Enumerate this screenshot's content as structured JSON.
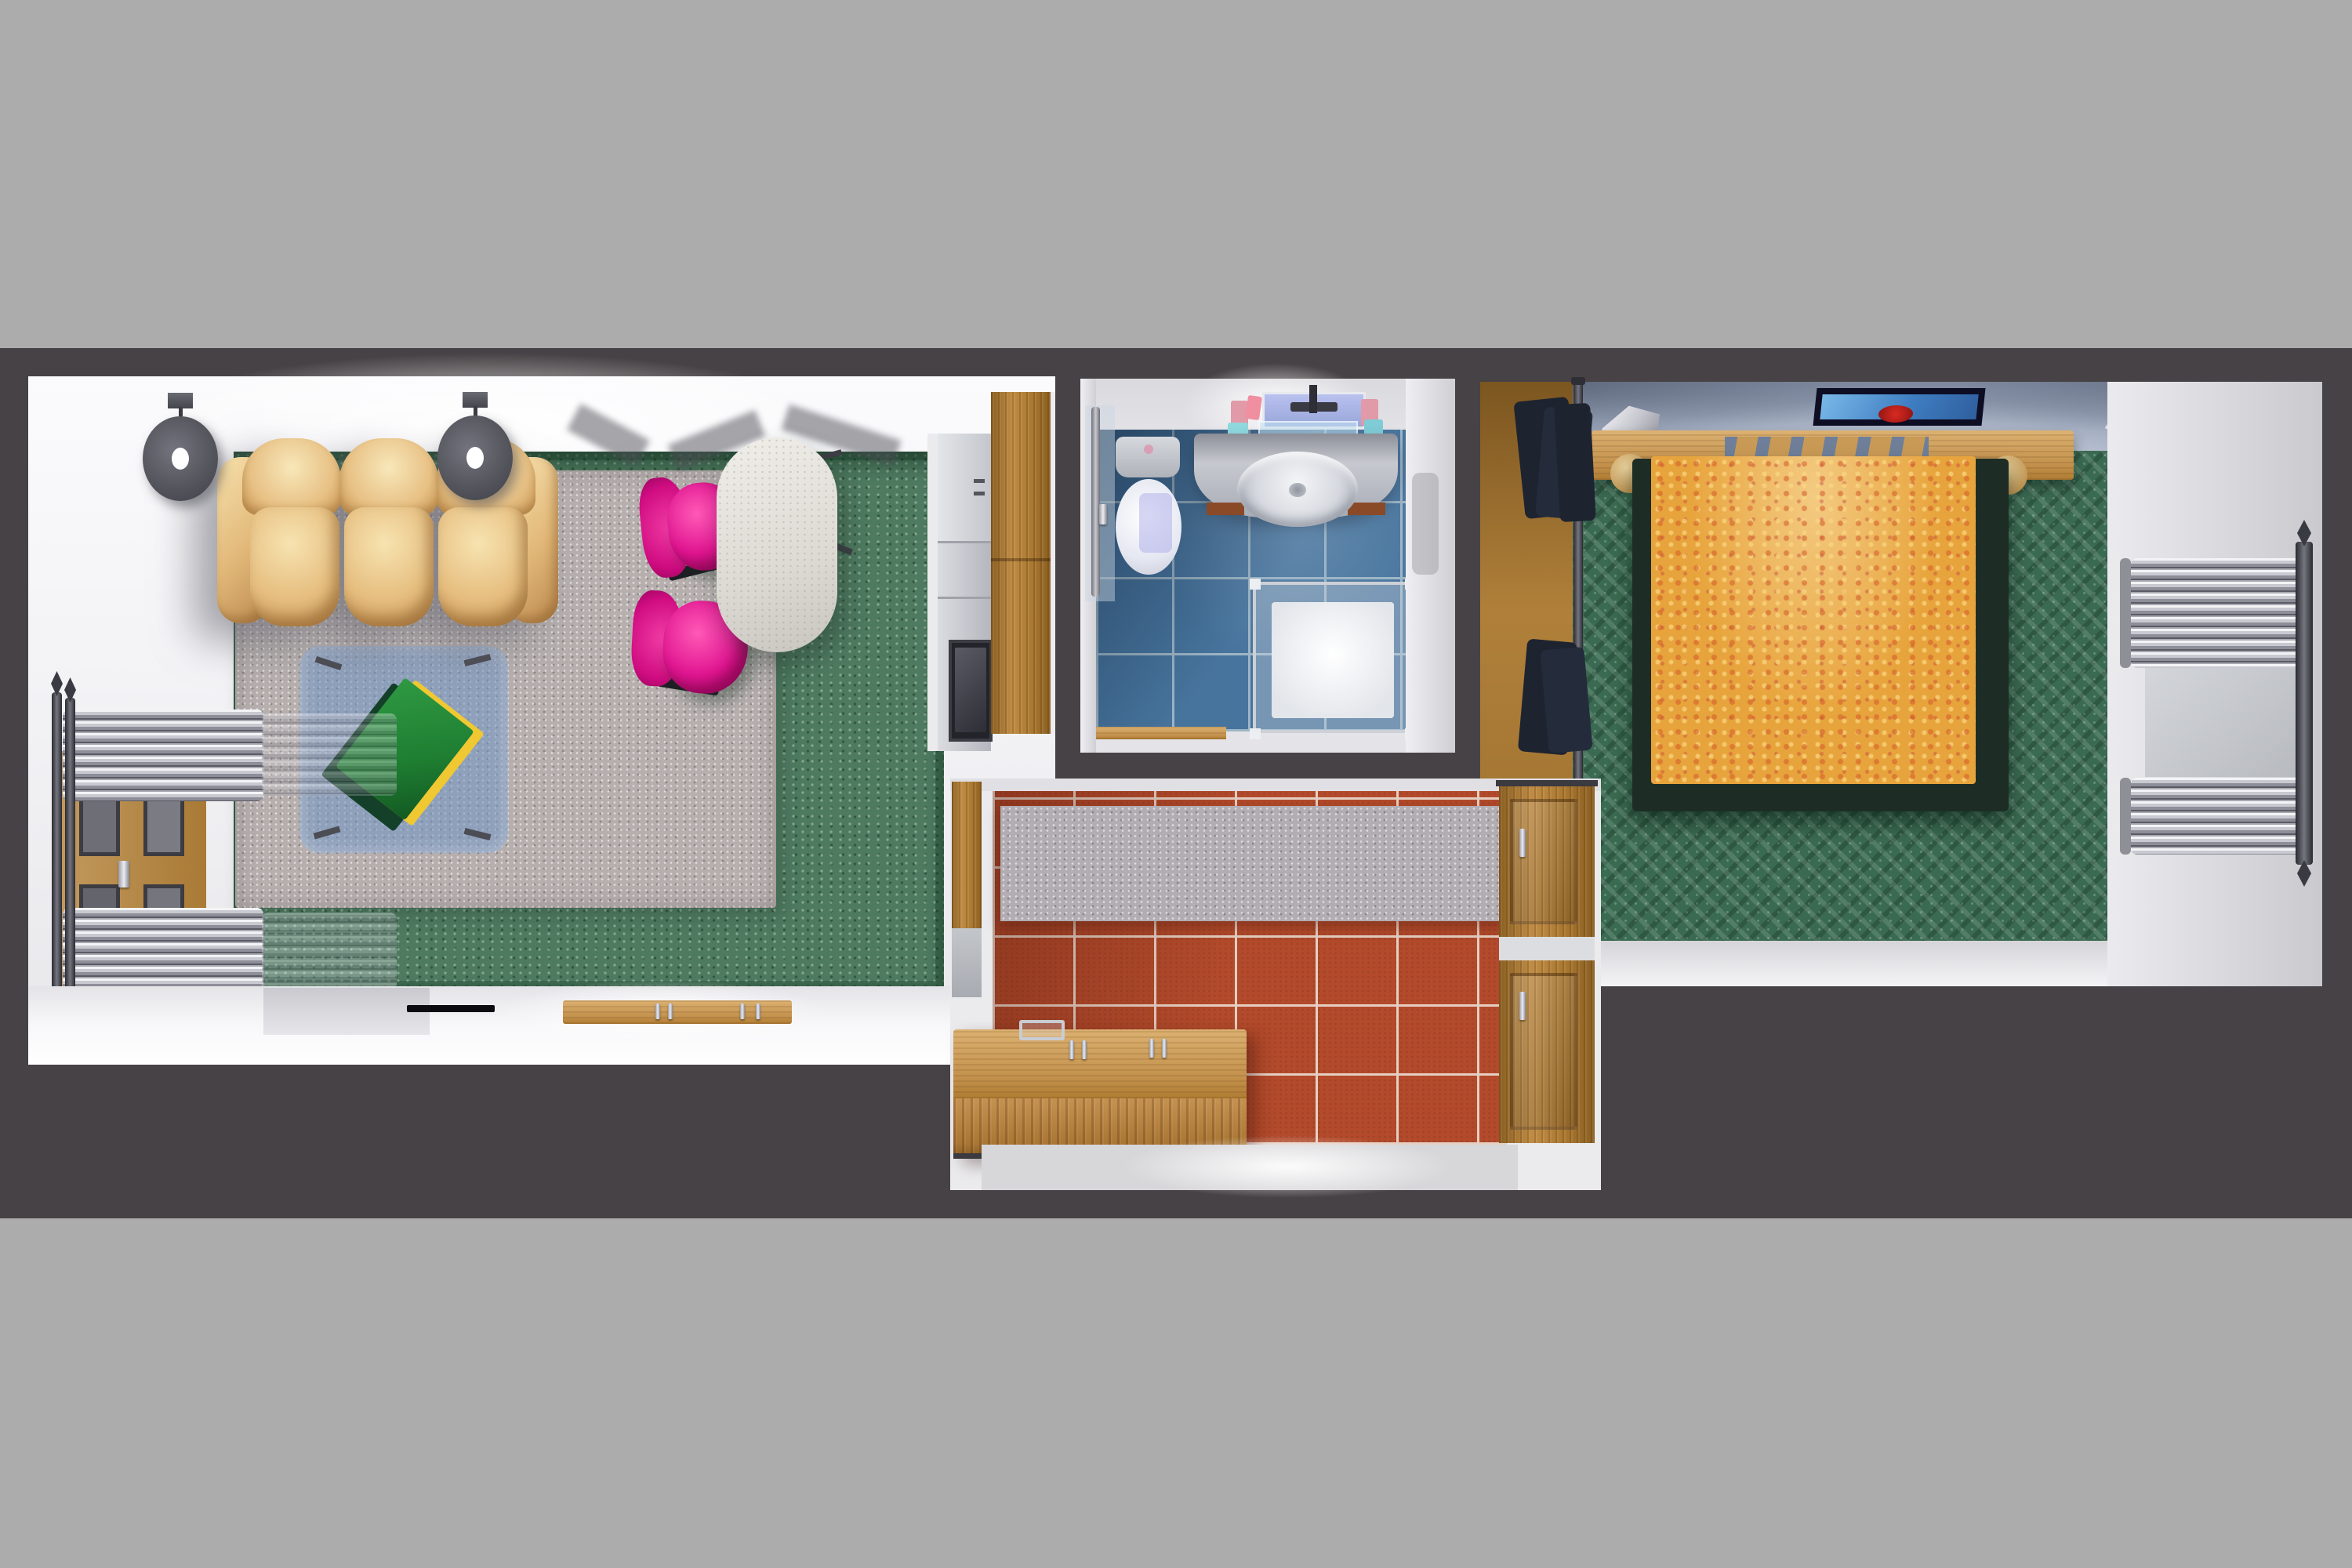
{
  "palette": {
    "backdrop": "#acacac",
    "slab": "#474245",
    "wall-light": "#f3f3f5",
    "carpet-green": "#4e7a60",
    "bedroom-carpet": "#3b6a52",
    "rug-gray": "#b6afae",
    "glass-blue": "#6f93c4",
    "sofa-tan": "#e7c084",
    "chair-pink": "#e01490",
    "table-top": "#e5e2dd",
    "wood": "#a9772f",
    "wood-light": "#cf9f5e",
    "tile-blue": "#47749d",
    "tile-red": "#b24a2b",
    "bed-orange": "#e8a43c",
    "bed-frame": "#1d2d25",
    "ceiling-blue": "#9aa5ba",
    "clothes": "#1d2430",
    "book-green": "#1e7d31",
    "book-yellow": "#f0c832",
    "tv-black": "#0c0c10",
    "metal-dark": "#3a3a42"
  },
  "scene": {
    "type": "3d-top-down-apartment-render",
    "rooms": [
      {
        "name": "living-room",
        "objects": [
          "leather-sofa",
          "wall-disc-speakers",
          "green-carpet",
          "gray-area-rug",
          "glass-coffee-table",
          "green-book",
          "pink-swivel-chairs",
          "dining-table",
          "kitchenette-counter",
          "sink",
          "stove",
          "tall-cabinet",
          "towel-radiator",
          "balcony-door",
          "bottom-shelf",
          "tv-remote-shelf",
          "sideboard-with-handles"
        ]
      },
      {
        "name": "bathroom",
        "objects": [
          "toilet",
          "cistern",
          "vanity-counter",
          "oval-sink",
          "faucet",
          "mirror",
          "cosmetic-bottles",
          "glass-shelf",
          "shower-enclosure",
          "shower-tray",
          "glass-door-rail",
          "blue-tile-floor",
          "wood-threshold"
        ]
      },
      {
        "name": "kitchen",
        "objects": [
          "red-tile-floor",
          "gray-floor-mat",
          "wood-island",
          "island-rack",
          "island-handles",
          "wall-cabinet-upper",
          "wall-cabinet-lower",
          "side-cabinet"
        ]
      },
      {
        "name": "bedroom",
        "objects": [
          "double-bed",
          "patterned-blanket",
          "headboard-canopy",
          "headboard-slats",
          "bed-posts",
          "wall-picture",
          "wall-lamps",
          "green-weave-carpet",
          "wardrobe-clothes",
          "clothes-rail",
          "radiator-window",
          "curtain-pole"
        ]
      }
    ]
  }
}
